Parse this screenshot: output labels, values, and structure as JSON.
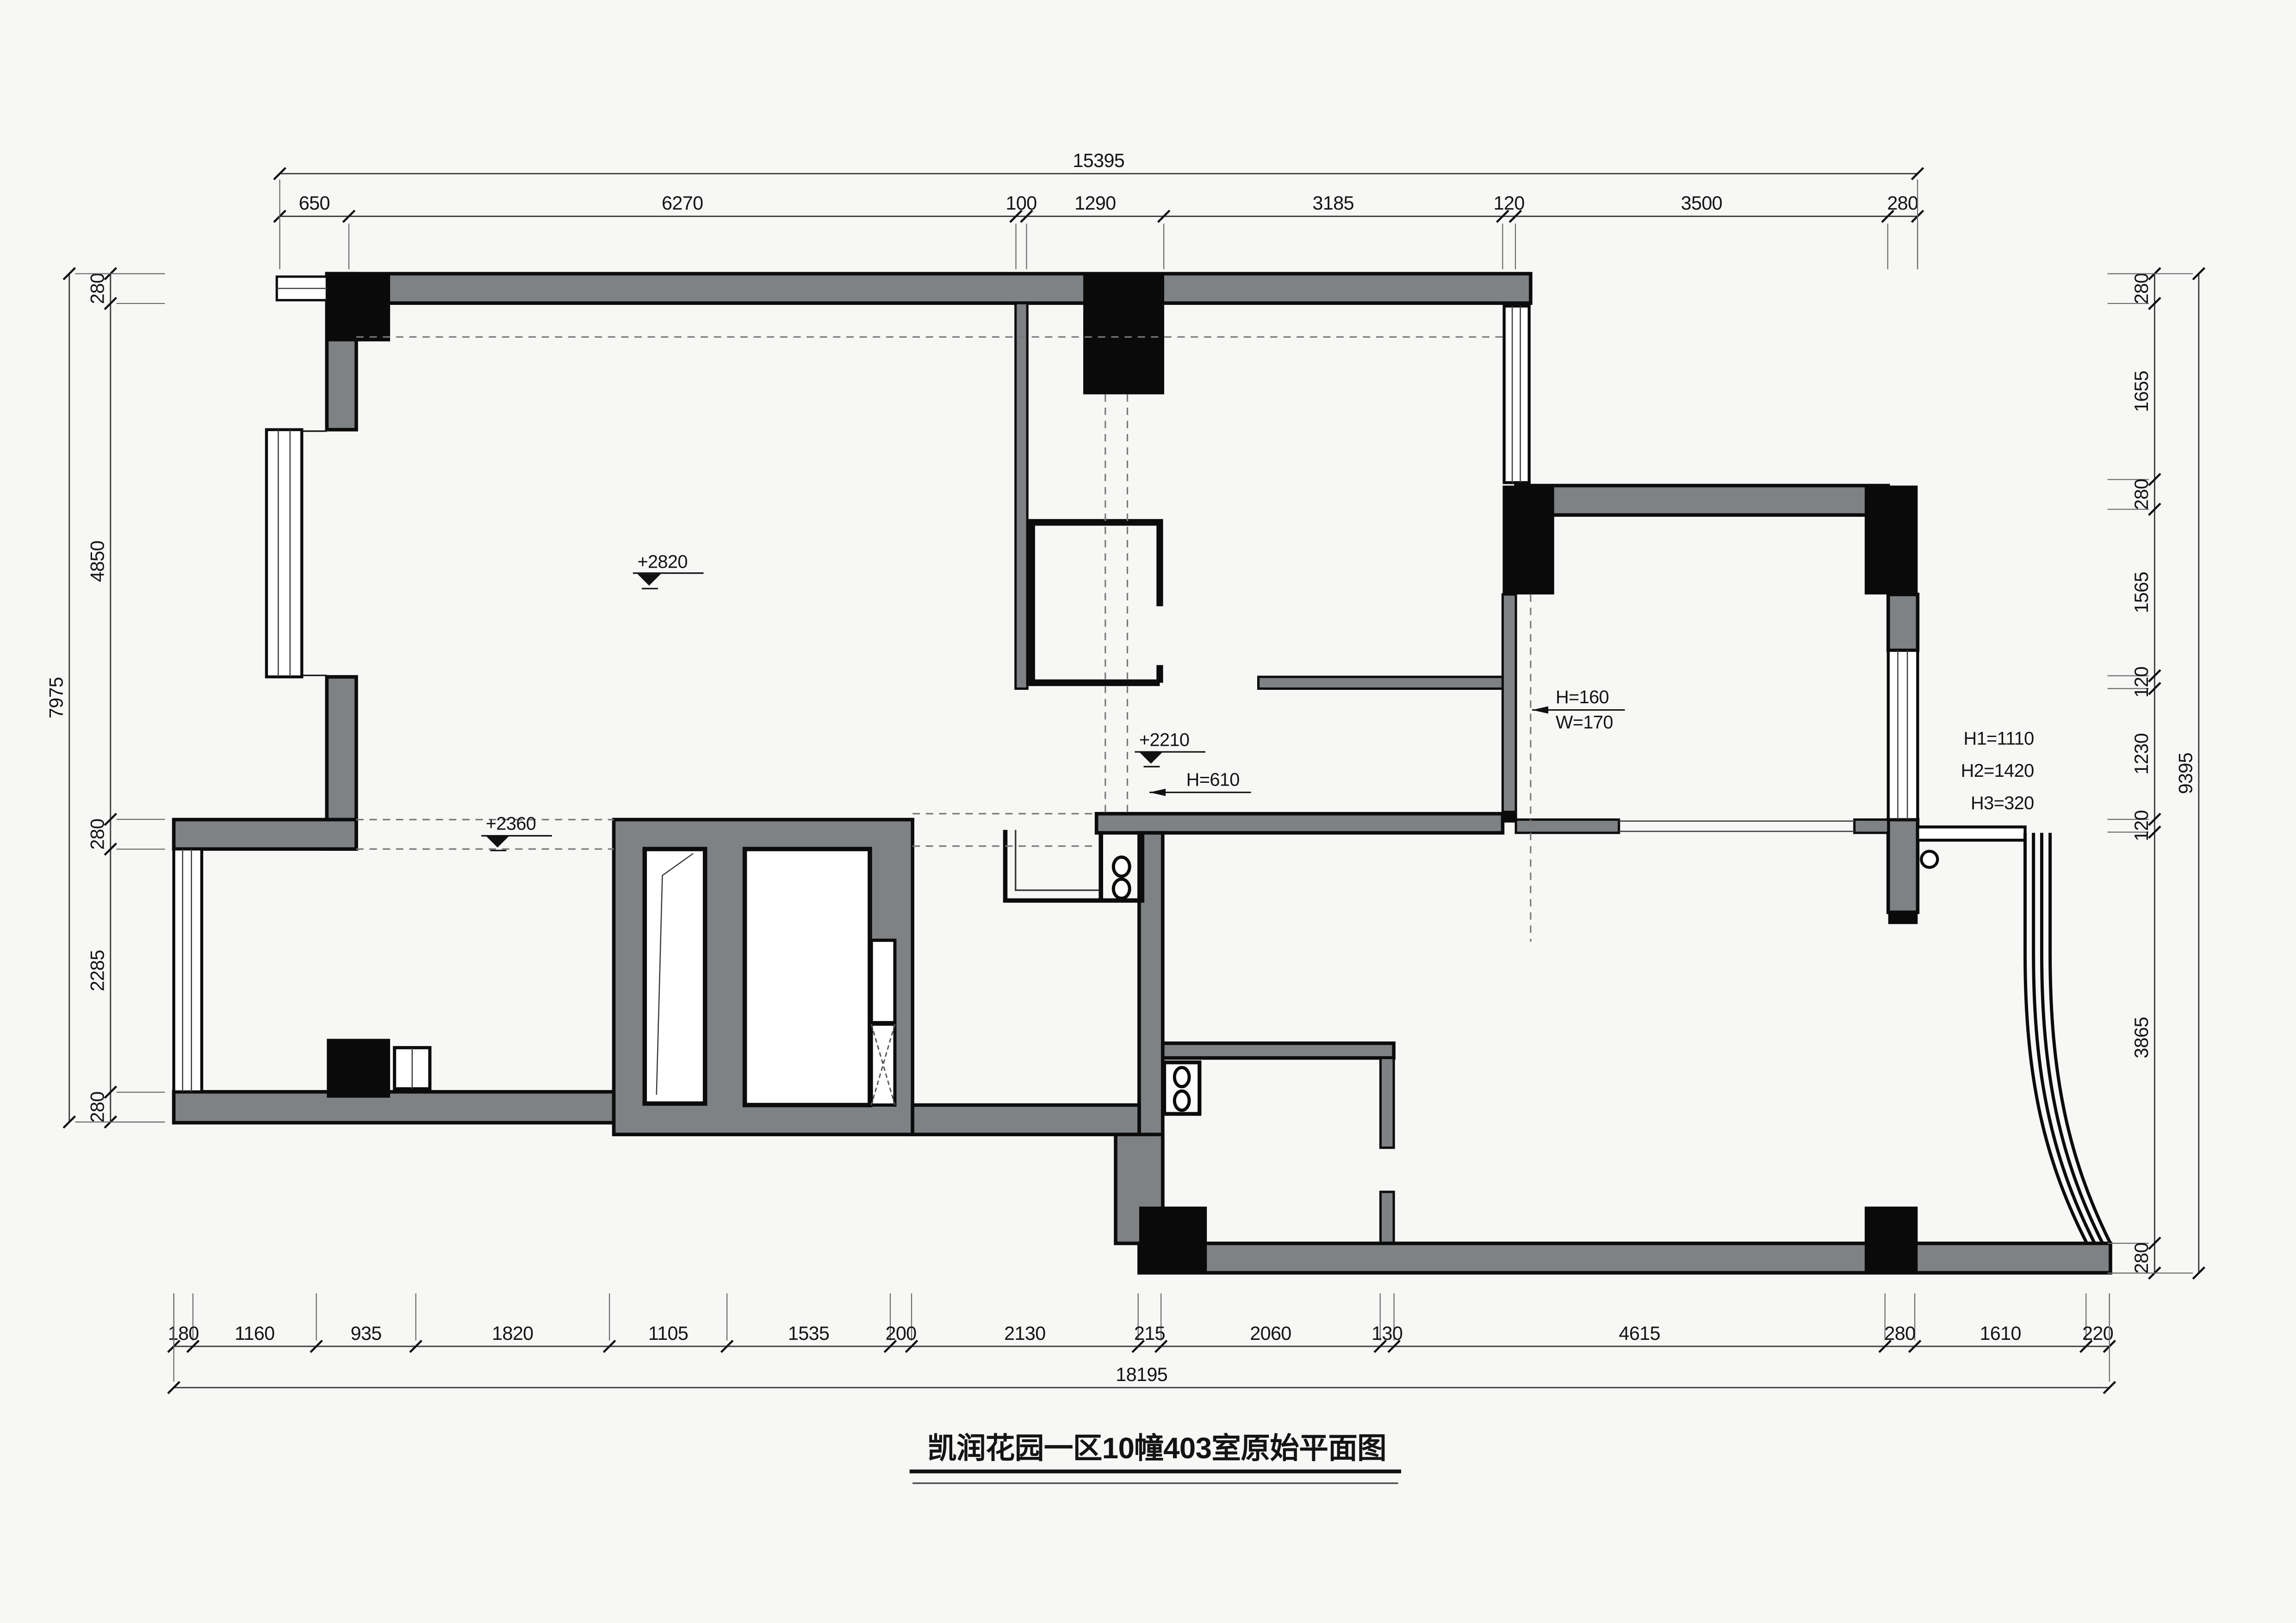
{
  "drawing": {
    "title": "凯润花园一区10幢403室原始平面图",
    "annotations": {
      "level_living": "+2820",
      "level_pass": "+2210",
      "pass_height": "H=610",
      "level_dining": "+2360",
      "niche_h": "H=160",
      "niche_w": "W=170",
      "window_h1": "H1=1110",
      "window_h2": "H2=1420",
      "window_h3": "H3=320"
    },
    "dims": {
      "top": {
        "overall": "15395",
        "segments": [
          "650",
          "6270",
          "100",
          "1290",
          "3185",
          "120",
          "3500",
          "280"
        ]
      },
      "bottom": {
        "overall": "18195",
        "segments": [
          "180",
          "1160",
          "935",
          "1820",
          "1105",
          "1535",
          "200",
          "2130",
          "215",
          "2060",
          "130",
          "4615",
          "280",
          "1610",
          "220"
        ]
      },
      "left": {
        "overall": "7975",
        "segments": [
          "280",
          "4850",
          "280",
          "2285",
          "280"
        ]
      },
      "right": {
        "overall": "9395",
        "segments": [
          "280",
          "1655",
          "280",
          "1565",
          "120",
          "1230",
          "120",
          "3865",
          "280"
        ]
      }
    },
    "colors": {
      "wall_gray": "#7f8284",
      "column_black": "#0a0a0a",
      "background": "#f7f7f6"
    }
  }
}
